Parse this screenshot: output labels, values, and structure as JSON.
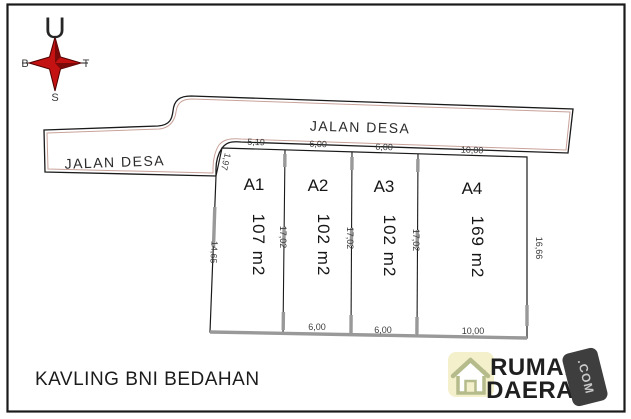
{
  "compass": {
    "north": "U",
    "east": "T",
    "south": "S",
    "west": "B"
  },
  "roads": {
    "left_label": "JALAN DESA",
    "top_label": "JALAN DESA"
  },
  "plots": {
    "ids": [
      "A1",
      "A2",
      "A3",
      "A4"
    ],
    "areas": [
      "107 m2",
      "102 m2",
      "102 m2",
      "169 m2"
    ],
    "top_dims": [
      "5,19",
      "6,00",
      "6,00",
      "10,00"
    ],
    "bottom_dims": [
      "6,00",
      "6,00",
      "10,00"
    ],
    "divider_dims": [
      "17,02",
      "17,02",
      "17,02"
    ],
    "right_dim": "16,66",
    "left_upper_dim": "1,97",
    "left_lower_dim": "14,65"
  },
  "title": "KAVLING BNI BEDAHAN",
  "logo": {
    "word1": "RUMAH",
    "word2": "DAERAH",
    "badge": ".COM"
  },
  "colors": {
    "line_black": "#1a1a1a",
    "road_inner": "#c9a29a",
    "gray_wall": "#999999",
    "compass_red": "#c41111",
    "logo_blue": "#3fa3da",
    "logo_orange": "#f28e2c",
    "logo_icon_bg": "#f3f0cb",
    "logo_icon_stroke": "#b5bb8b",
    "badge_bg": "#3e3e3e"
  }
}
